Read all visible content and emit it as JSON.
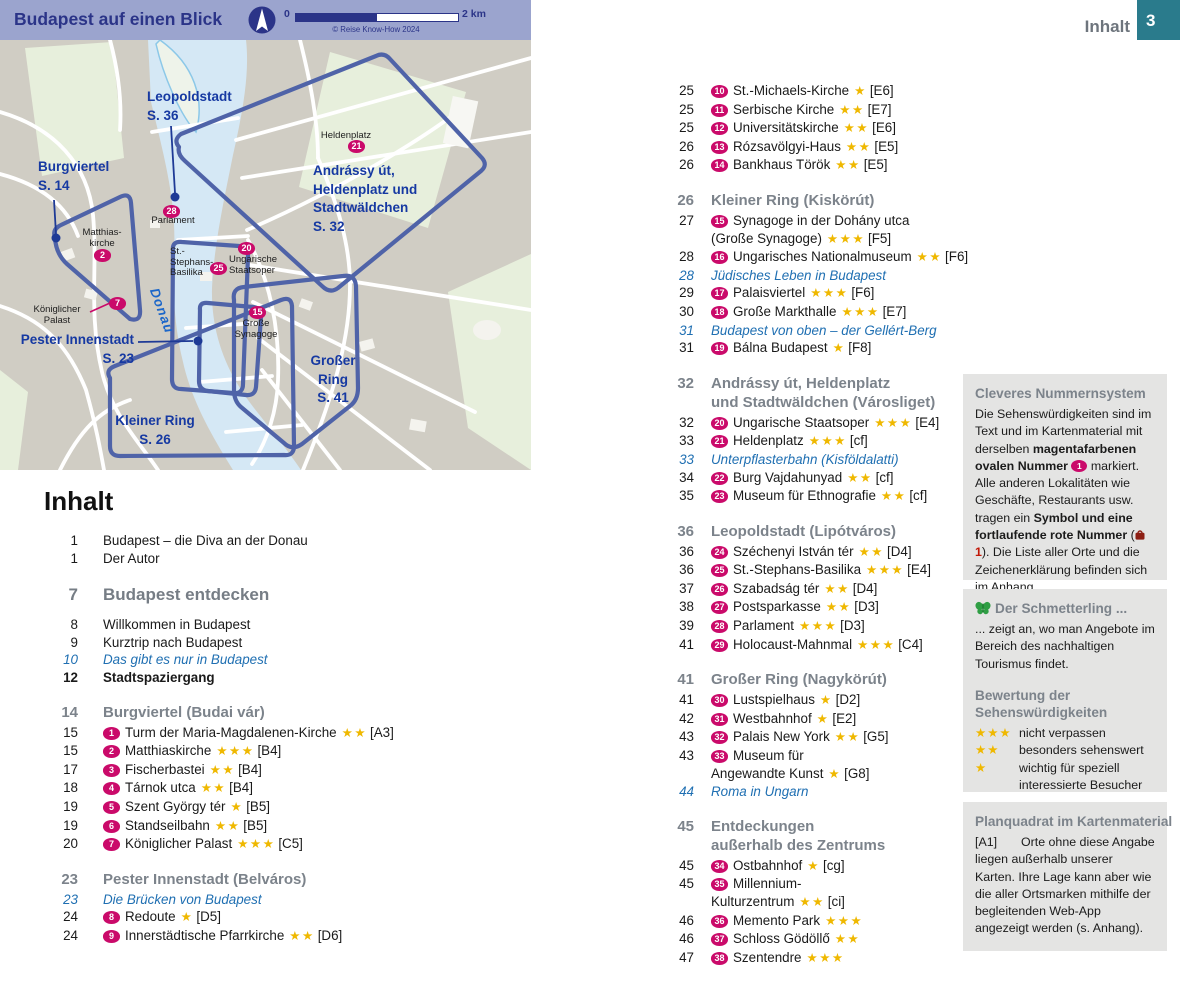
{
  "header": {
    "label": "Inhalt",
    "page": "3"
  },
  "map": {
    "title": "Budapest auf einen Blick",
    "copyright": "© Reise Know-How 2024",
    "scale_start": "0",
    "scale_end": "2 km",
    "river_label": "Donau",
    "districts": {
      "leopoldstadt": {
        "line1": "Leopoldstadt",
        "line2": "S. 36"
      },
      "burgviertel": {
        "line1": "Burgviertel",
        "line2": "S. 14"
      },
      "andrassy": {
        "line1": "Andrássy út,",
        "line2": "Heldenplatz und",
        "line3": "Stadtwäldchen",
        "line4": "S. 32"
      },
      "pester": {
        "line1": "Pester Innenstadt",
        "line2": "S. 23"
      },
      "kleiner": {
        "line1": "Kleiner Ring",
        "line2": "S. 26"
      },
      "grosser": {
        "line1": "Großer",
        "line2": "Ring",
        "line3": "S. 41"
      }
    },
    "landmarks": {
      "heldenplatz": {
        "badge": "21",
        "line1": "Heldenplatz"
      },
      "matthias": {
        "badge": "2",
        "line1": "Matthias-",
        "line2": "kirche"
      },
      "parlament": {
        "badge": "28",
        "line1": "Parlament"
      },
      "basilika": {
        "badge": "25",
        "line1": "St.-",
        "line2": "Stephans-",
        "line3": "Basilika"
      },
      "staatsoper": {
        "badge": "20",
        "line1": "Ungarische",
        "line2": "Staatsoper"
      },
      "palast": {
        "badge": "7",
        "line1": "Königlicher",
        "line2": "Palast"
      },
      "synagoge": {
        "badge": "15",
        "line1": "Große",
        "line2": "Synagoge"
      }
    }
  },
  "toc": {
    "title": "Inhalt",
    "left": [
      {
        "type": "plain",
        "page": "1",
        "text": "Budapest – die Diva an der Donau"
      },
      {
        "type": "plain",
        "page": "1",
        "text": "Der Autor"
      },
      {
        "type": "chapter",
        "page": "7",
        "lines": [
          "Budapest entdecken"
        ]
      },
      {
        "type": "plain",
        "page": "8",
        "text": "Willkommen in Budapest"
      },
      {
        "type": "plain",
        "page": "9",
        "text": "Kurztrip nach Budapest"
      },
      {
        "type": "italic",
        "page": "10",
        "text": "Das gibt es nur in Budapest"
      },
      {
        "type": "bold",
        "page": "12",
        "text": "Stadtspaziergang"
      },
      {
        "type": "section",
        "page": "14",
        "lines": [
          "Burgviertel (Budai vár)"
        ]
      },
      {
        "type": "entry",
        "page": "15",
        "badge": "1",
        "text": "Turm der Maria-Magdalenen-Kirche",
        "stars": 2,
        "grid": "[A3]"
      },
      {
        "type": "entry",
        "page": "15",
        "badge": "2",
        "text": "Matthiaskirche",
        "stars": 3,
        "grid": "[B4]"
      },
      {
        "type": "entry",
        "page": "17",
        "badge": "3",
        "text": "Fischerbastei",
        "stars": 2,
        "grid": "[B4]"
      },
      {
        "type": "entry",
        "page": "18",
        "badge": "4",
        "text": "Tárnok utca",
        "stars": 2,
        "grid": "[B4]"
      },
      {
        "type": "entry",
        "page": "19",
        "badge": "5",
        "text": "Szent György tér",
        "stars": 1,
        "grid": "[B5]"
      },
      {
        "type": "entry",
        "page": "19",
        "badge": "6",
        "text": "Standseilbahn",
        "stars": 2,
        "grid": "[B5]"
      },
      {
        "type": "entry",
        "page": "20",
        "badge": "7",
        "text": "Königlicher Palast",
        "stars": 3,
        "grid": "[C5]"
      },
      {
        "type": "section",
        "page": "23",
        "lines": [
          "Pester Innenstadt (Belváros)"
        ]
      },
      {
        "type": "italic",
        "page": "23",
        "text": "Die Brücken von Budapest"
      },
      {
        "type": "entry",
        "page": "24",
        "badge": "8",
        "text": "Redoute",
        "stars": 1,
        "grid": "[D5]"
      },
      {
        "type": "entry",
        "page": "24",
        "badge": "9",
        "text": "Innerstädtische Pfarrkirche",
        "stars": 2,
        "grid": "[D6]"
      }
    ],
    "right": [
      {
        "type": "entry",
        "page": "25",
        "badge": "10",
        "text": "St.-Michaels-Kirche",
        "stars": 1,
        "grid": "[E6]"
      },
      {
        "type": "entry",
        "page": "25",
        "badge": "11",
        "text": "Serbische Kirche",
        "stars": 2,
        "grid": "[E7]"
      },
      {
        "type": "entry",
        "page": "25",
        "badge": "12",
        "text": "Universitätskirche",
        "stars": 2,
        "grid": "[E6]"
      },
      {
        "type": "entry",
        "page": "26",
        "badge": "13",
        "text": "Rózsavölgyi-Haus",
        "stars": 2,
        "grid": "[E5]"
      },
      {
        "type": "entry",
        "page": "26",
        "badge": "14",
        "text": "Bankhaus Török",
        "stars": 2,
        "grid": "[E5]"
      },
      {
        "type": "section",
        "page": "26",
        "lines": [
          "Kleiner Ring (Kiskörút)"
        ]
      },
      {
        "type": "entry",
        "page": "27",
        "badge": "15",
        "text": "Synagoge in der Dohány utca",
        "line2": "(Große Synagoge)",
        "stars2": 3,
        "grid2": "[F5]"
      },
      {
        "type": "entry",
        "page": "28",
        "badge": "16",
        "text": "Ungarisches Nationalmuseum",
        "stars": 2,
        "grid": "[F6]"
      },
      {
        "type": "italic",
        "page": "28",
        "text": "Jüdisches Leben in Budapest"
      },
      {
        "type": "entry",
        "page": "29",
        "badge": "17",
        "text": "Palaisviertel",
        "stars": 3,
        "grid": "[F6]"
      },
      {
        "type": "entry",
        "page": "30",
        "badge": "18",
        "text": "Große Markthalle",
        "stars": 3,
        "grid": "[E7]"
      },
      {
        "type": "italic",
        "page": "31",
        "text": "Budapest von oben – der Gellért-Berg"
      },
      {
        "type": "entry",
        "page": "31",
        "badge": "19",
        "text": "Bálna Budapest",
        "stars": 1,
        "grid": "[F8]"
      },
      {
        "type": "section",
        "page": "32",
        "lines": [
          "Andrássy út, Heldenplatz",
          "und Stadtwäldchen (Városliget)"
        ]
      },
      {
        "type": "entry",
        "page": "32",
        "badge": "20",
        "text": "Ungarische Staatsoper",
        "stars": 3,
        "grid": "[E4]"
      },
      {
        "type": "entry",
        "page": "33",
        "badge": "21",
        "text": "Heldenplatz",
        "stars": 3,
        "grid": "[cf]"
      },
      {
        "type": "italic",
        "page": "33",
        "text": "Unterpflasterbahn (Kisföldalatti)"
      },
      {
        "type": "entry",
        "page": "34",
        "badge": "22",
        "text": "Burg Vajdahunyad",
        "stars": 2,
        "grid": "[cf]"
      },
      {
        "type": "entry",
        "page": "35",
        "badge": "23",
        "text": "Museum für Ethnografie",
        "stars": 2,
        "grid": "[cf]"
      },
      {
        "type": "section",
        "page": "36",
        "lines": [
          "Leopoldstadt (Lipótváros)"
        ]
      },
      {
        "type": "entry",
        "page": "36",
        "badge": "24",
        "text": "Széchenyi István tér",
        "stars": 2,
        "grid": "[D4]"
      },
      {
        "type": "entry",
        "page": "36",
        "badge": "25",
        "text": "St.-Stephans-Basilika",
        "stars": 3,
        "grid": "[E4]"
      },
      {
        "type": "entry",
        "page": "37",
        "badge": "26",
        "text": "Szabadság tér",
        "stars": 2,
        "grid": "[D4]"
      },
      {
        "type": "entry",
        "page": "38",
        "badge": "27",
        "text": "Postsparkasse",
        "stars": 2,
        "grid": "[D3]"
      },
      {
        "type": "entry",
        "page": "39",
        "badge": "28",
        "text": "Parlament",
        "stars": 3,
        "grid": "[D3]"
      },
      {
        "type": "entry",
        "page": "41",
        "badge": "29",
        "text": "Holocaust-Mahnmal",
        "stars": 3,
        "grid": "[C4]"
      },
      {
        "type": "section",
        "page": "41",
        "lines": [
          "Großer Ring (Nagykörút)"
        ]
      },
      {
        "type": "entry",
        "page": "41",
        "badge": "30",
        "text": "Lustspielhaus",
        "stars": 1,
        "grid": "[D2]"
      },
      {
        "type": "entry",
        "page": "42",
        "badge": "31",
        "text": "Westbahnhof",
        "stars": 1,
        "grid": "[E2]"
      },
      {
        "type": "entry",
        "page": "43",
        "badge": "32",
        "text": "Palais New York",
        "stars": 2,
        "grid": "[G5]"
      },
      {
        "type": "entry",
        "page": "43",
        "badge": "33",
        "text": "Museum für",
        "line2": "Angewandte Kunst",
        "stars2": 1,
        "grid2": "[G8]"
      },
      {
        "type": "italic",
        "page": "44",
        "text": "Roma in Ungarn"
      },
      {
        "type": "section",
        "page": "45",
        "lines": [
          "Entdeckungen",
          "außerhalb des Zentrums"
        ]
      },
      {
        "type": "entry",
        "page": "45",
        "badge": "34",
        "text": "Ostbahnhof",
        "stars": 1,
        "grid": "[cg]"
      },
      {
        "type": "entry",
        "page": "45",
        "badge": "35",
        "text": "Millennium-",
        "line2": "Kulturzentrum",
        "stars2": 2,
        "grid2": "[ci]"
      },
      {
        "type": "entry",
        "page": "46",
        "badge": "36",
        "text": "Memento Park",
        "stars": 3
      },
      {
        "type": "entry",
        "page": "46",
        "badge": "37",
        "text": "Schloss Gödöllő",
        "stars": 2
      },
      {
        "type": "entry",
        "page": "47",
        "badge": "38",
        "text": "Szentendre",
        "stars": 3
      }
    ]
  },
  "sidebar": {
    "box1": {
      "title": "Cleveres Nummernsystem",
      "segments": [
        {
          "t": "Die Sehenswürdigkeiten sind im Text und im Kartenmaterial mit derselben "
        },
        {
          "t": "magentafarbenen ovalen Nummer ",
          "b": true
        },
        {
          "badge": "1"
        },
        {
          "t": " markiert. Alle anderen Lokalitäten wie Geschäfte, Restaurants usw. tragen ein "
        },
        {
          "t": "Symbol und eine fortlaufende rote Nummer",
          "b": true
        },
        {
          "t": " ("
        },
        {
          "icon": "bag"
        },
        {
          "t": "1",
          "red": true
        },
        {
          "t": "). Die Liste aller Orte und die Zeichenerklärung befinden sich im Anhang."
        }
      ]
    },
    "box2": {
      "butterfly_title": "Der Schmetterling ...",
      "butterfly_text": "... zeigt an, wo man Angebote im Bereich des nachhaltigen Tourismus findet.",
      "rating_title1": "Bewertung der",
      "rating_title2": "Sehenswürdigkeiten",
      "ratings": [
        {
          "stars": 3,
          "label": "nicht verpassen"
        },
        {
          "stars": 2,
          "label": "besonders sehenswert"
        },
        {
          "stars": 1,
          "label": "wichtig für speziell interessierte Besucher"
        }
      ]
    },
    "box3": {
      "title": "Planquadrat im Kartenmaterial",
      "grid_ref": "[A1]",
      "text": "Orte ohne diese Angabe liegen außerhalb unserer Karten. Ihre Lage kann aber wie die aller Ortsmarken mithilfe der begleitenden Web-App angezeigt werden (s. Anhang)."
    }
  },
  "colors": {
    "magenta": "#ca0a6a",
    "star_gold": "#efb800",
    "teal_tab": "#2a7b8c",
    "map_header": "#9ba4ce",
    "navy": "#2b3488",
    "district_outline": "#4f63a8",
    "italic_blue": "#1f6fb2",
    "section_gray": "#7c838b"
  }
}
